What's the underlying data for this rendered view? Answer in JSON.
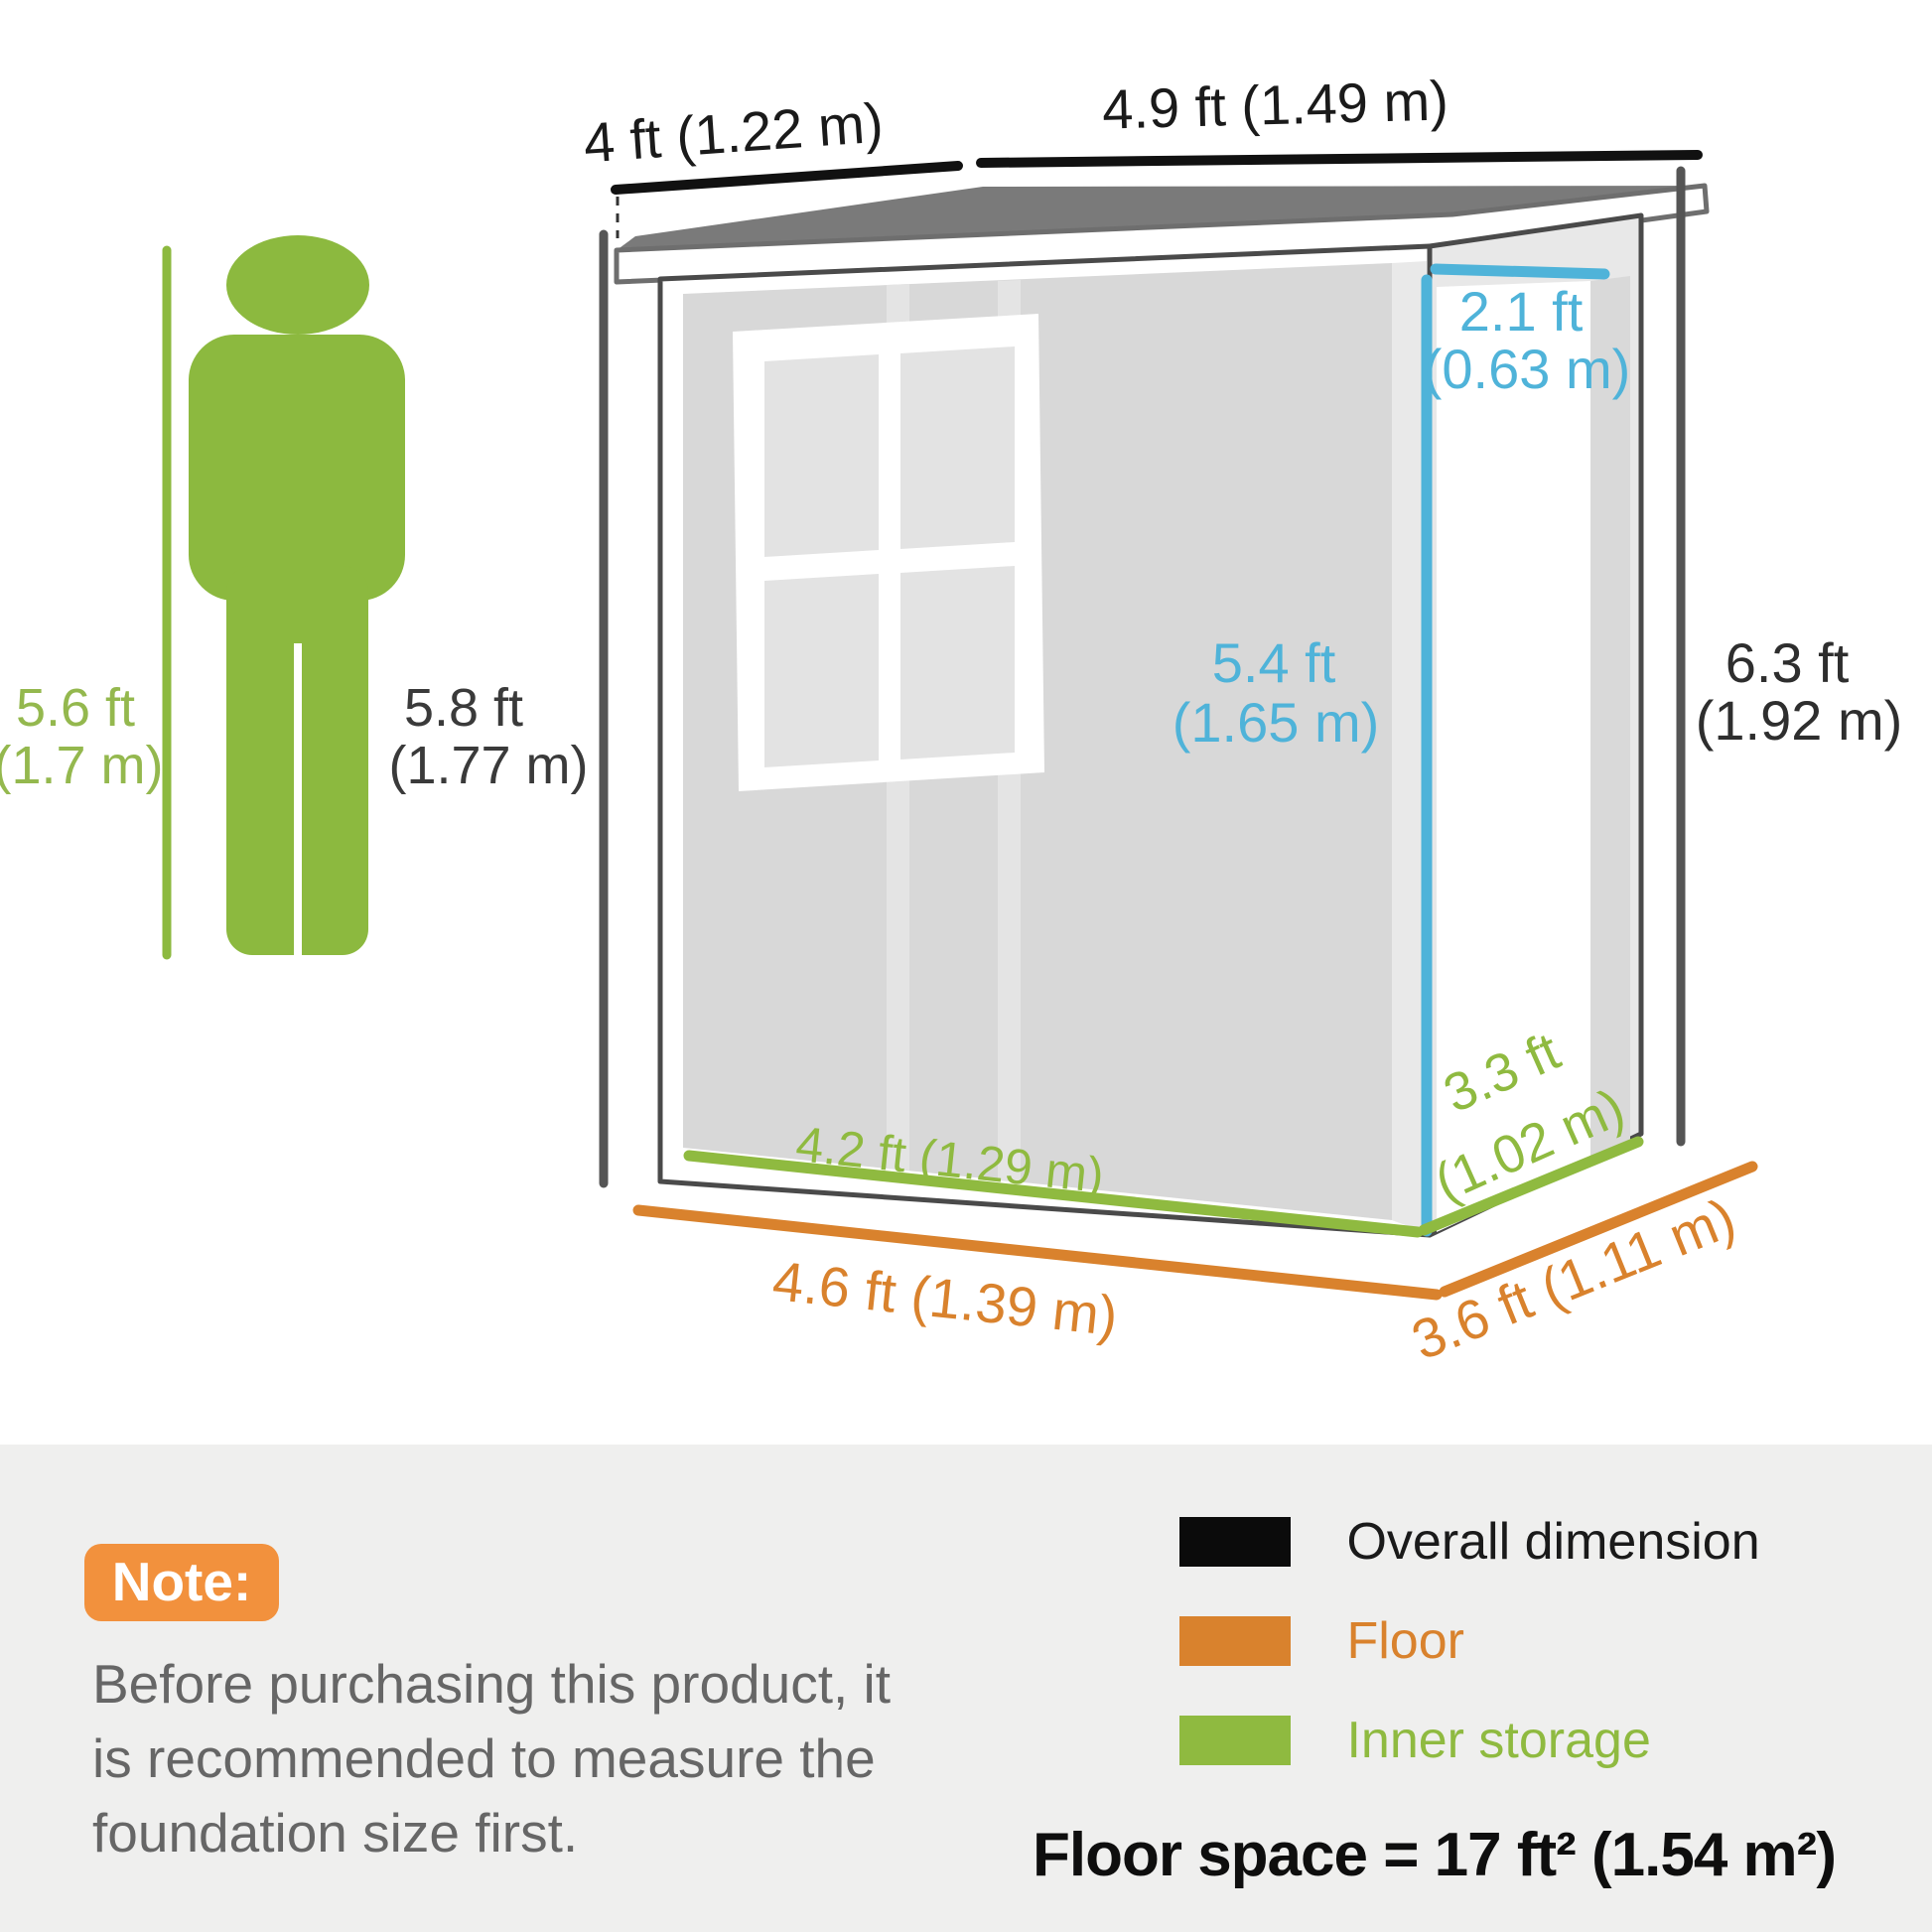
{
  "diagram_title": "Shed dimension diagram",
  "person": {
    "height_ref": [
      "5.6 ft",
      "(1.7 m)"
    ],
    "wall_low_side_height": [
      "5.8 ft",
      "(1.77 m)"
    ]
  },
  "shed": {
    "roof_depth": "4 ft (1.22 m)",
    "roof_width": "4.9 ft (1.49 m)",
    "door_width": [
      "2.1 ft",
      "(0.63 m)"
    ],
    "door_height": [
      "5.4 ft",
      "(1.65 m)"
    ],
    "overall_height": [
      "6.3 ft",
      "(1.92 m)"
    ],
    "inner_width": "4.2 ft (1.29 m)",
    "inner_depth": [
      "3.3 ft",
      "(1.02 m)"
    ],
    "floor_width": "4.6 ft (1.39 m)",
    "floor_depth": "3.6 ft (1.11 m)"
  },
  "note": {
    "badge": "Note:",
    "lines": [
      "Before purchasing this product, it",
      "is recommended to measure the",
      "foundation size first."
    ]
  },
  "legend": {
    "items": [
      {
        "label": "Overall dimension",
        "color": "#0b0b0b"
      },
      {
        "label": "Floor",
        "color": "#d9822d"
      },
      {
        "label": "Inner storage",
        "color": "#8fba40"
      }
    ],
    "floor_space": "Floor space = 17 ft² (1.54 m²)"
  },
  "colors": {
    "overall_dimension": "#0b0b0b",
    "floor": "#d9822d",
    "inner_storage": "#8fba40",
    "door_measure_blue": "#4fb3d9",
    "measure_line_gray": "#4d4d4d",
    "roof_gray": "#7a7a7a",
    "wall_gray": "#d8d8d8",
    "note_badge_orange": "#f2913d",
    "panel_background": "#efefee"
  }
}
